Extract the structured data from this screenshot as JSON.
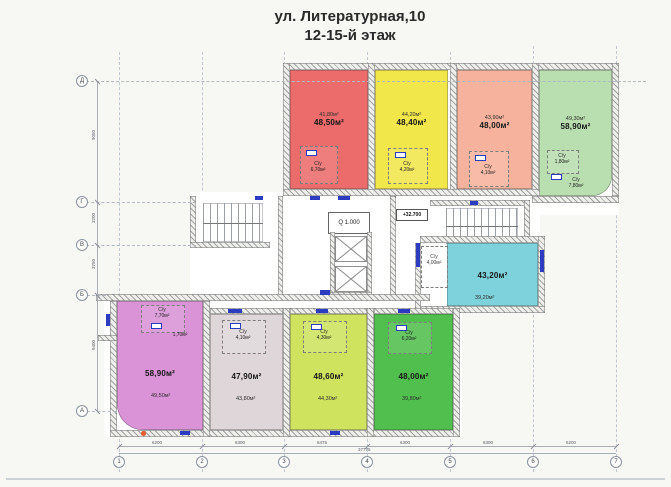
{
  "title": {
    "line1": "ул. Литературная,10",
    "line2": "12-15-й этаж"
  },
  "core": {
    "elevator_note": "Q 1.000",
    "level_mark": "+32.700"
  },
  "apartments": [
    {
      "name": "top-red",
      "total": "48,50м²",
      "room": "41,80м²",
      "bath_label": "С/у",
      "bath": "6,70м²",
      "color": "#ec6b6b"
    },
    {
      "name": "top-yellow",
      "total": "48,40м²",
      "room": "44,20м²",
      "bath_label": "С/у",
      "bath": "4,20м²",
      "color": "#f1e64a"
    },
    {
      "name": "top-salmon",
      "total": "48,00м²",
      "room": "43,90м²",
      "bath_label": "С/у",
      "bath": "4,10м²",
      "color": "#f6b29d"
    },
    {
      "name": "top-green",
      "total": "58,90м²",
      "room": "49,30м²",
      "bath_label": "С/у",
      "bath": "1,80м²",
      "bath2_label": "С/у",
      "bath2": "7,80м²",
      "color": "#b9dfb0"
    },
    {
      "name": "mid-teal",
      "total": "43,20м²",
      "room": "39,20м²",
      "bath_label": "С/у",
      "bath": "4,00м²",
      "color": "#7ed2dc"
    },
    {
      "name": "bottom-purple",
      "total": "58,90м²",
      "room": "49,50м²",
      "bath_label": "С/у",
      "bath": "7,70м²",
      "hall": "1,70м²",
      "color": "#d993d6"
    },
    {
      "name": "bottom-mauve",
      "total": "47,90м²",
      "room": "43,80м²",
      "bath_label": "С/у",
      "bath": "4,10м²",
      "color": "#ded6d9"
    },
    {
      "name": "bottom-lime",
      "total": "48,60м²",
      "room": "44,30м²",
      "bath_label": "С/у",
      "bath": "4,30м²",
      "color": "#cfe35f"
    },
    {
      "name": "bottom-green",
      "total": "48,00м²",
      "room": "39,80м²",
      "bath_label": "С/у",
      "bath": "6,20м²",
      "color": "#50bf4d"
    }
  ],
  "grid": {
    "rows": [
      "Д",
      "Г",
      "В",
      "Б",
      "А"
    ],
    "cols": [
      "1",
      "2",
      "3",
      "4",
      "5",
      "6",
      "7"
    ]
  },
  "dimensions": {
    "bottom": [
      "6200",
      "6300",
      "6475",
      "6300",
      "6300",
      "6200"
    ],
    "bottom_total": "37775",
    "left": [
      "9050",
      "3200",
      "3750",
      "9400"
    ]
  }
}
